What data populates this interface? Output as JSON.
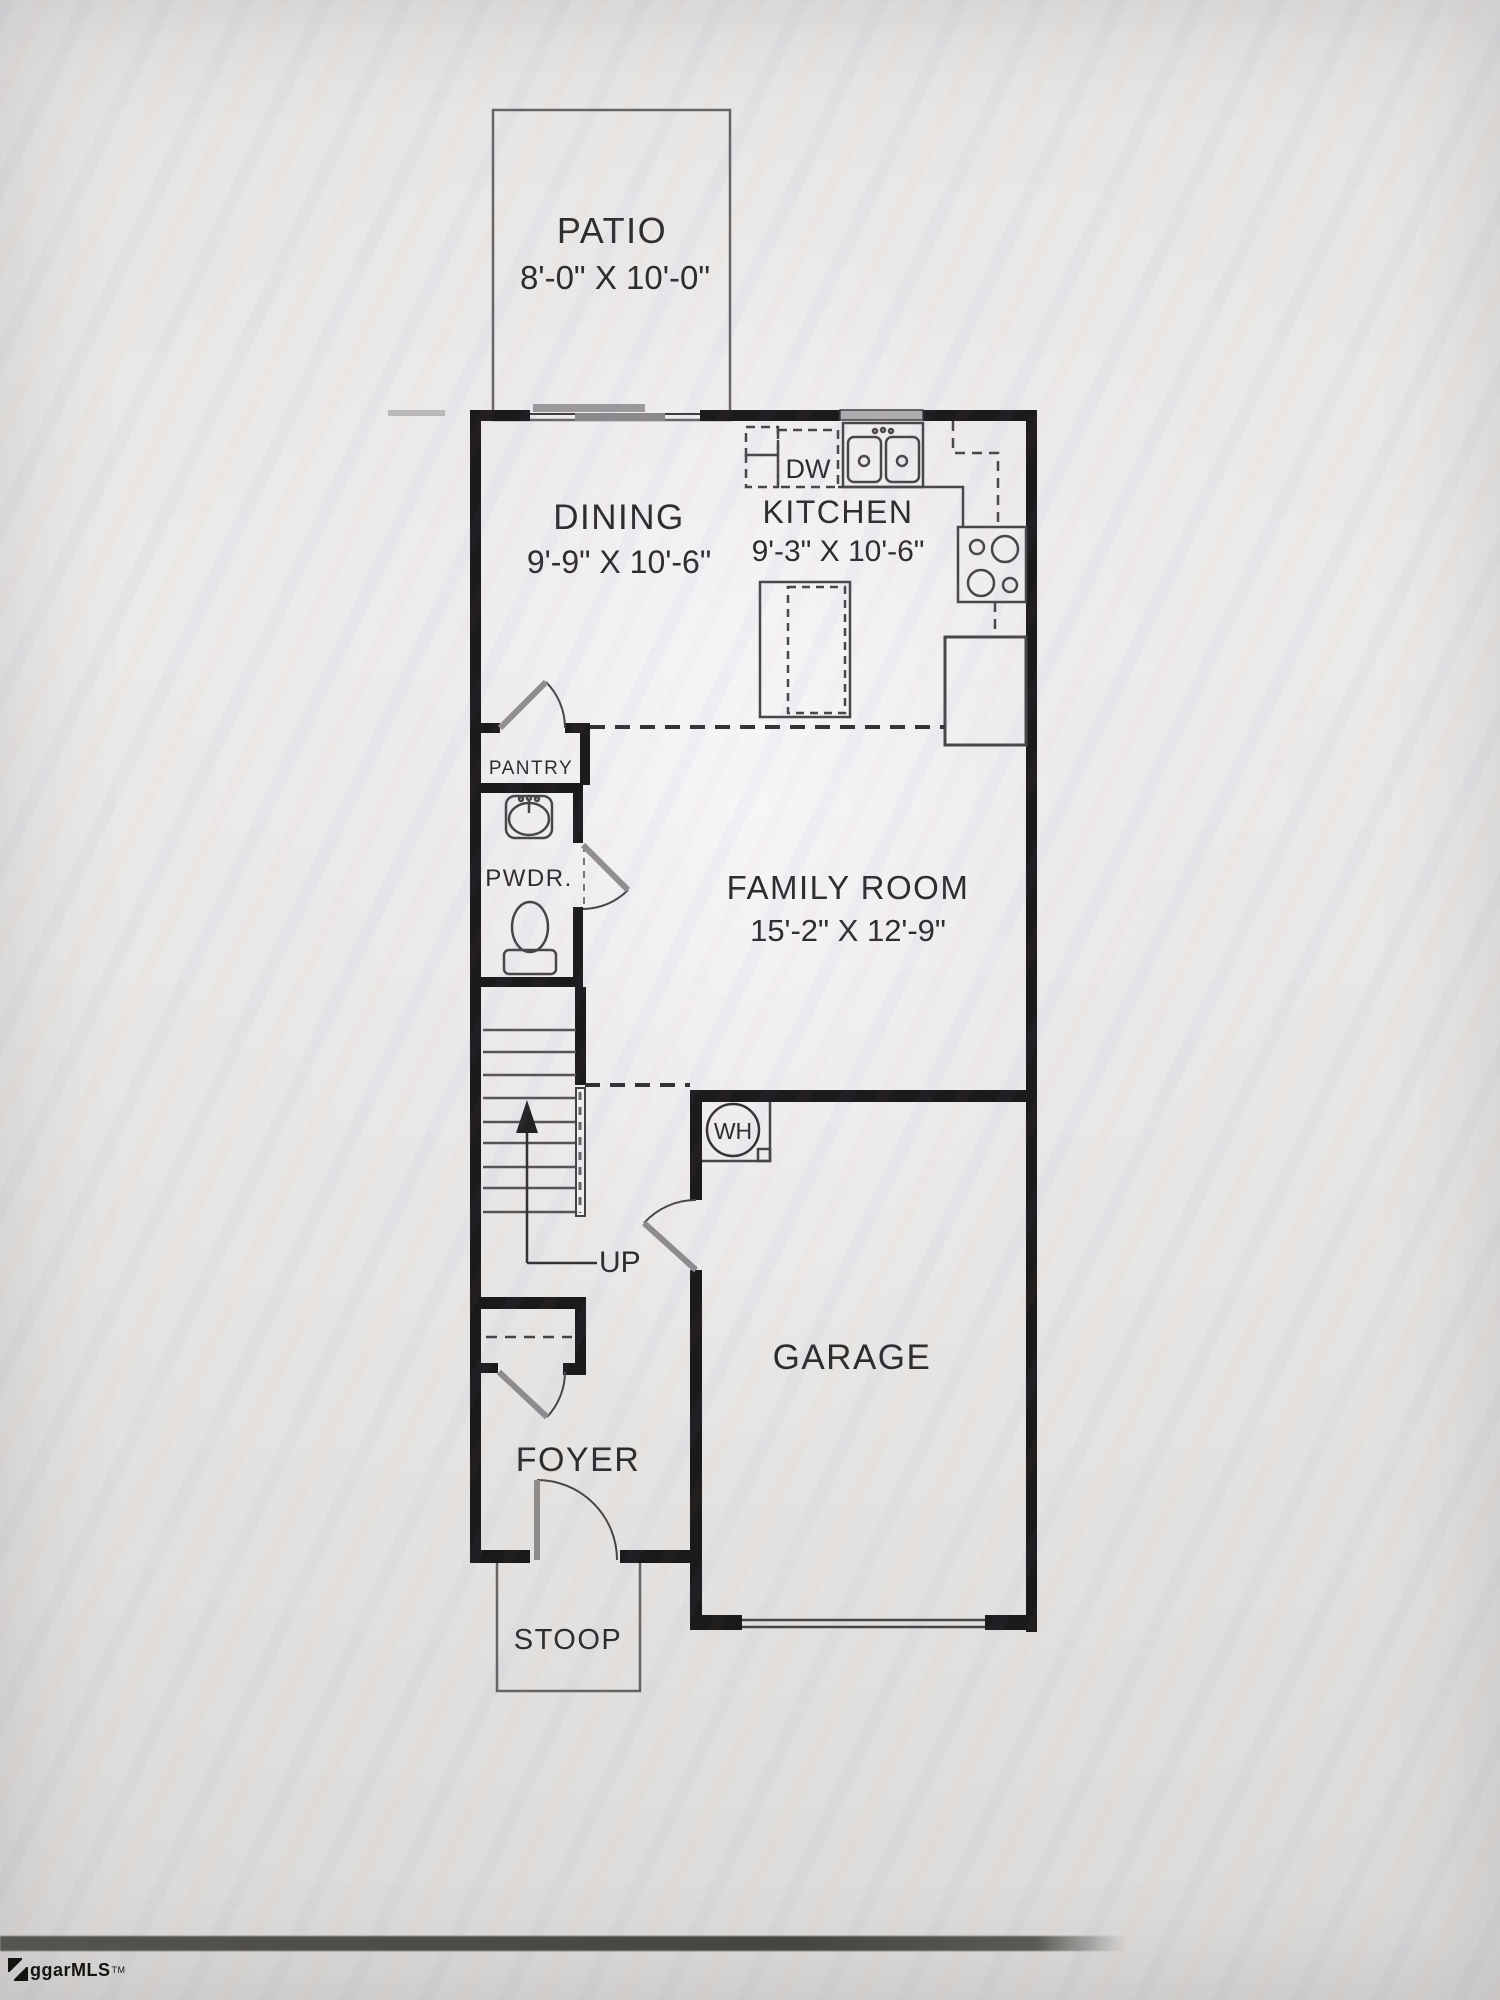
{
  "rooms": {
    "patio": {
      "name": "PATIO",
      "dims": "8'-0\" X 10'-0\""
    },
    "dining": {
      "name": "DINING",
      "dims": "9'-9\" X 10'-6\""
    },
    "kitchen": {
      "name": "KITCHEN",
      "dims": "9'-3\" X 10'-6\""
    },
    "family": {
      "name": "FAMILY ROOM",
      "dims": "15'-2\" X 12'-9\""
    },
    "pantry": {
      "name": "PANTRY"
    },
    "powder": {
      "name": "PWDR."
    },
    "garage": {
      "name": "GARAGE"
    },
    "foyer": {
      "name": "FOYER"
    },
    "stoop": {
      "name": "STOOP"
    }
  },
  "labels": {
    "dishwasher": "DW",
    "water_heater": "WH",
    "stairs_up": "UP"
  },
  "watermark": {
    "text": "ggarMLS",
    "tm": "TM"
  },
  "colors": {
    "wall": "#1b1b1b",
    "line": "#4c4c4c",
    "dash": "#3f3f3f",
    "door_leaf": "#8f8f8f",
    "window": "#aeaeae",
    "background": "#e9e8e6"
  }
}
